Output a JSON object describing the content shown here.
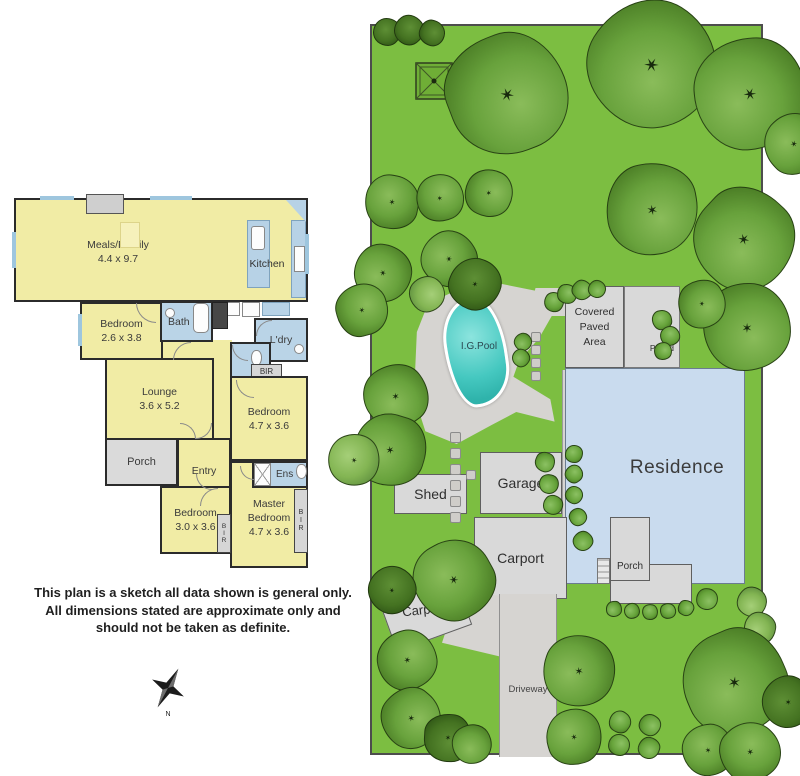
{
  "floorplan": {
    "rooms": {
      "meals_family": {
        "label": "Meals/Family",
        "dims": "4.4 x 9.7"
      },
      "kitchen": {
        "label": "Kitchen"
      },
      "bedroom_1": {
        "label": "Bedroom",
        "dims": "2.6 x 3.8"
      },
      "bath": {
        "label": "Bath"
      },
      "laundry": {
        "label": "L'dry"
      },
      "bir_hall": {
        "label": "BIR"
      },
      "lounge": {
        "label": "Lounge",
        "dims": "3.6 x 5.2"
      },
      "porch": {
        "label": "Porch"
      },
      "entry": {
        "label": "Entry"
      },
      "bedroom_2": {
        "label": "Bedroom",
        "dims": "4.7 x 3.6"
      },
      "ensuite": {
        "label": "Ens"
      },
      "bedroom_3": {
        "label": "Bedroom",
        "dims": "3.0 x 3.6"
      },
      "master_bedroom": {
        "line1": "Master",
        "line2": "Bedroom",
        "dims": "4.7 x 3.6"
      },
      "bir_master": {
        "letters": [
          "B",
          "I",
          "R"
        ]
      },
      "bir_bedroom_3": {
        "letters": [
          "B",
          "I",
          "R"
        ]
      }
    },
    "disclaimer": [
      "This plan is a sketch all data shown is general only.",
      "All dimensions stated are approximate only and",
      "should not be taken as definite."
    ],
    "compass": {
      "north_label": "N"
    }
  },
  "siteplan": {
    "labels": {
      "pool": "I.G.Pool",
      "covered_paved_area": [
        "Covered",
        "Paved",
        "Area"
      ],
      "paved": "Paved",
      "residence": "Residence",
      "porch": "Porch",
      "shed": "Shed",
      "garage": "Garage",
      "carport_upper": "Carport",
      "carport_lower": "Carport",
      "driveway": "Driveway"
    },
    "colors": {
      "lawn": "#7cbe41",
      "pool_water": "#45c8c0",
      "residence_fill": "#c9dbee",
      "paving": "#d6d4d1",
      "structure_fill": "#d9d9d9"
    }
  }
}
